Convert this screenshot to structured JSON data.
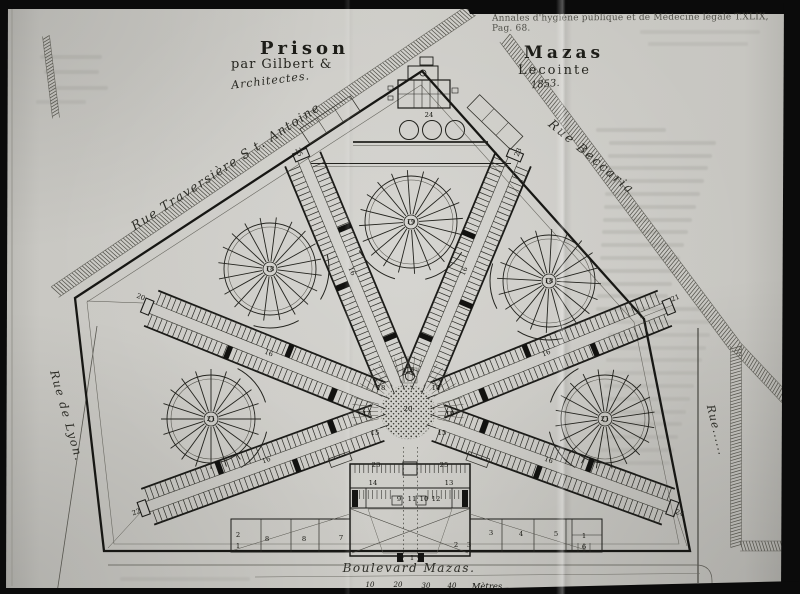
{
  "colors": {
    "paper": "#c9c8c3",
    "ink": "#1c1c18",
    "scan_black": "#0b0b0b"
  },
  "page": {
    "journal_caption": "Annales d'hygiène publique et de Médecine légale T.XLIX, Pag. 68.",
    "title_left": "Prison",
    "title_left_credit": "par Gilbert &",
    "title_left_role": "Architectes.",
    "title_right": "Mazas",
    "title_right_credit": "Lecointe",
    "title_right_year": "1853."
  },
  "streets": {
    "top_left": "Rue Traversière S t. Antoine",
    "top_right": "Rue Beccaria",
    "left": "Rue de Lyon.",
    "right": "Rue......",
    "bottom": "Boulevard Mazas."
  },
  "scale_bar": {
    "ticks": [
      "10",
      "20",
      "30",
      "40"
    ],
    "unit": "Mètres"
  },
  "plan_numbers": [
    {
      "label": "22",
      "x": 137,
      "y": 514,
      "rot": -20
    },
    {
      "label": "20",
      "x": 140,
      "y": 299,
      "rot": 22
    },
    {
      "label": "25",
      "x": 297,
      "y": 153,
      "rot": 67
    },
    {
      "label": "23",
      "x": 520,
      "y": 153,
      "rot": -67
    },
    {
      "label": "21",
      "x": 676,
      "y": 300,
      "rot": -22
    },
    {
      "label": "24",
      "x": 679,
      "y": 515,
      "rot": 20
    },
    {
      "label": "16",
      "x": 267,
      "y": 462,
      "rot": -20
    },
    {
      "label": "16",
      "x": 268,
      "y": 355,
      "rot": 22
    },
    {
      "label": "16",
      "x": 350,
      "y": 272,
      "rot": 67
    },
    {
      "label": "16",
      "x": 466,
      "y": 272,
      "rot": -67
    },
    {
      "label": "16",
      "x": 547,
      "y": 355,
      "rot": -22
    },
    {
      "label": "16",
      "x": 548,
      "y": 462,
      "rot": 20
    },
    {
      "label": "21",
      "x": 211,
      "y": 421,
      "rot": 0
    },
    {
      "label": "18",
      "x": 270,
      "y": 271,
      "rot": 0
    },
    {
      "label": "19",
      "x": 411,
      "y": 224,
      "rot": 0
    },
    {
      "label": "18",
      "x": 549,
      "y": 283,
      "rot": 0
    },
    {
      "label": "21",
      "x": 605,
      "y": 421,
      "rot": 0
    },
    {
      "label": "20",
      "x": 408,
      "y": 411,
      "rot": 0
    },
    {
      "label": "13",
      "x": 410,
      "y": 372,
      "rot": 0
    },
    {
      "label": "18",
      "x": 381,
      "y": 390,
      "rot": 0
    },
    {
      "label": "14",
      "x": 436,
      "y": 390,
      "rot": 0
    },
    {
      "label": "17",
      "x": 367,
      "y": 416,
      "rot": 0
    },
    {
      "label": "19",
      "x": 450,
      "y": 416,
      "rot": 0
    },
    {
      "label": "15",
      "x": 375,
      "y": 435,
      "rot": 0
    },
    {
      "label": "15",
      "x": 442,
      "y": 435,
      "rot": 0
    },
    {
      "label": "24",
      "x": 429,
      "y": 117,
      "rot": 0
    },
    {
      "label": "14",
      "x": 373,
      "y": 485,
      "rot": 0
    },
    {
      "label": "13",
      "x": 449,
      "y": 485,
      "rot": 0
    },
    {
      "label": "9",
      "x": 399,
      "y": 501,
      "rot": 0
    },
    {
      "label": "11",
      "x": 412,
      "y": 501,
      "rot": 0
    },
    {
      "label": "10",
      "x": 424,
      "y": 501,
      "rot": 0
    },
    {
      "label": "12",
      "x": 436,
      "y": 501,
      "rot": 0
    },
    {
      "label": "23",
      "x": 376,
      "y": 467,
      "rot": 0
    },
    {
      "label": "25",
      "x": 444,
      "y": 467,
      "rot": 0
    },
    {
      "label": "2",
      "x": 456,
      "y": 547,
      "rot": 0
    },
    {
      "label": "3",
      "x": 469,
      "y": 547,
      "rot": 0
    },
    {
      "label": "1",
      "x": 412,
      "y": 560,
      "rot": 0
    },
    {
      "label": "7",
      "x": 341,
      "y": 540,
      "rot": 0
    },
    {
      "label": "8",
      "x": 304,
      "y": 541,
      "rot": 0
    },
    {
      "label": "8",
      "x": 267,
      "y": 541,
      "rot": 0
    },
    {
      "label": "2",
      "x": 238,
      "y": 537,
      "rot": 0
    },
    {
      "label": "1",
      "x": 238,
      "y": 548,
      "rot": 0
    },
    {
      "label": "3",
      "x": 491,
      "y": 535,
      "rot": 0
    },
    {
      "label": "4",
      "x": 521,
      "y": 536,
      "rot": 0
    },
    {
      "label": "5",
      "x": 556,
      "y": 536,
      "rot": 0
    },
    {
      "label": "1",
      "x": 584,
      "y": 538,
      "rot": 0
    },
    {
      "label": "6",
      "x": 584,
      "y": 549,
      "rot": 0
    }
  ]
}
